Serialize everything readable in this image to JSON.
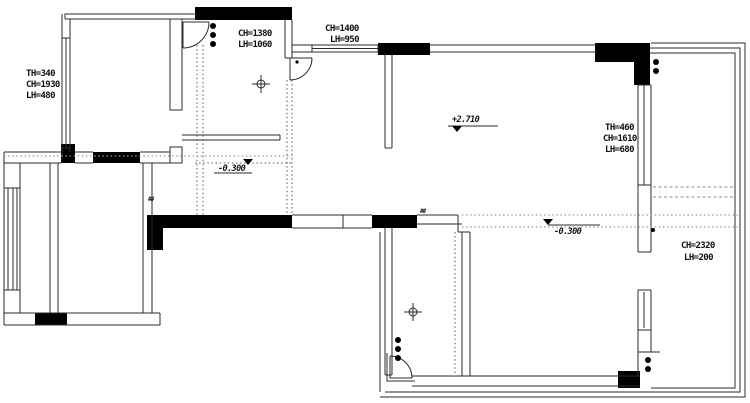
{
  "drawing": {
    "type": "apartment-floor-plan-structural-survey",
    "labels": {
      "top_left_dims": [
        "TH=340",
        "CH=1930",
        "LH=480"
      ],
      "hall_dims": [
        "CH=1380",
        "LH=1060"
      ],
      "top_mid_dims": [
        "CH=1400",
        "LH=950"
      ],
      "right_dims": [
        "TH=460",
        "CH=1610",
        "LH=680"
      ],
      "balcony_dims": [
        "CH=2320",
        "LH=200"
      ],
      "level_living": "+2.710",
      "level_entry": "-0.300",
      "level_terrace": "-0.300",
      "tiny_mark_left": "##",
      "tiny_mark_mid": "##"
    },
    "colors": {
      "background": "#ffffff",
      "wall_fill": "#000000",
      "wall_line": "#2b2b2b",
      "reference_dotted": "#555555",
      "reference_gray": "#9a9a9a",
      "text": "#111111"
    }
  }
}
